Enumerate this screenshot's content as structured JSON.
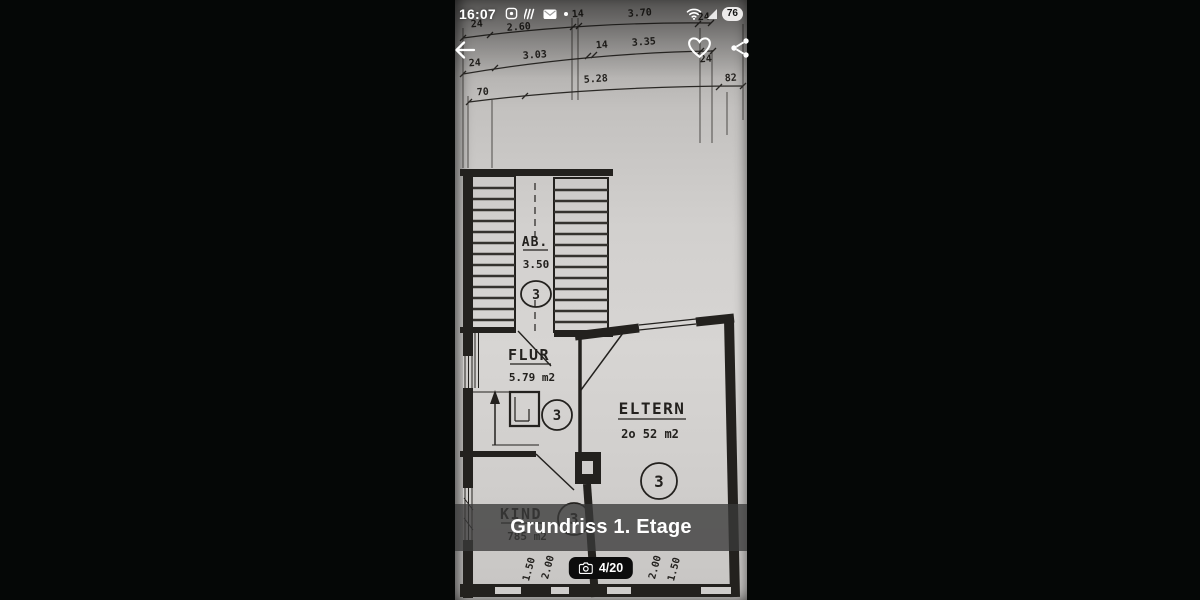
{
  "status_bar": {
    "time": "16:07",
    "battery_percent": "76"
  },
  "gallery": {
    "caption": "Grundriss 1. Etage",
    "photo_counter": "4/20"
  },
  "floor_plan": {
    "dims_row1": [
      "24",
      "2.60",
      "14",
      "3.70",
      "24"
    ],
    "dims_row2": [
      "24",
      "3.03",
      "14",
      "3.35",
      "24"
    ],
    "dims_row3": [
      "70",
      "5.28",
      "82"
    ],
    "rooms": {
      "stairs": {
        "label": "AB.",
        "area": "3.50",
        "number": "3"
      },
      "flur": {
        "label": "FLUR",
        "area": "5.79 m2",
        "number": "3"
      },
      "eltern": {
        "label": "ELTERN",
        "area": "2o 52 m2",
        "number": "3"
      },
      "kind": {
        "label": "KIND",
        "area": "785 m2",
        "number": "3"
      }
    },
    "dims_bottom": [
      "1.50",
      "2.00",
      "2.00",
      "1.50"
    ]
  },
  "colors": {
    "letterbox": "#050706",
    "paper": "#d2d0ce",
    "ink": "#23211e",
    "caption_band": "rgba(58,58,58,0.78)"
  }
}
